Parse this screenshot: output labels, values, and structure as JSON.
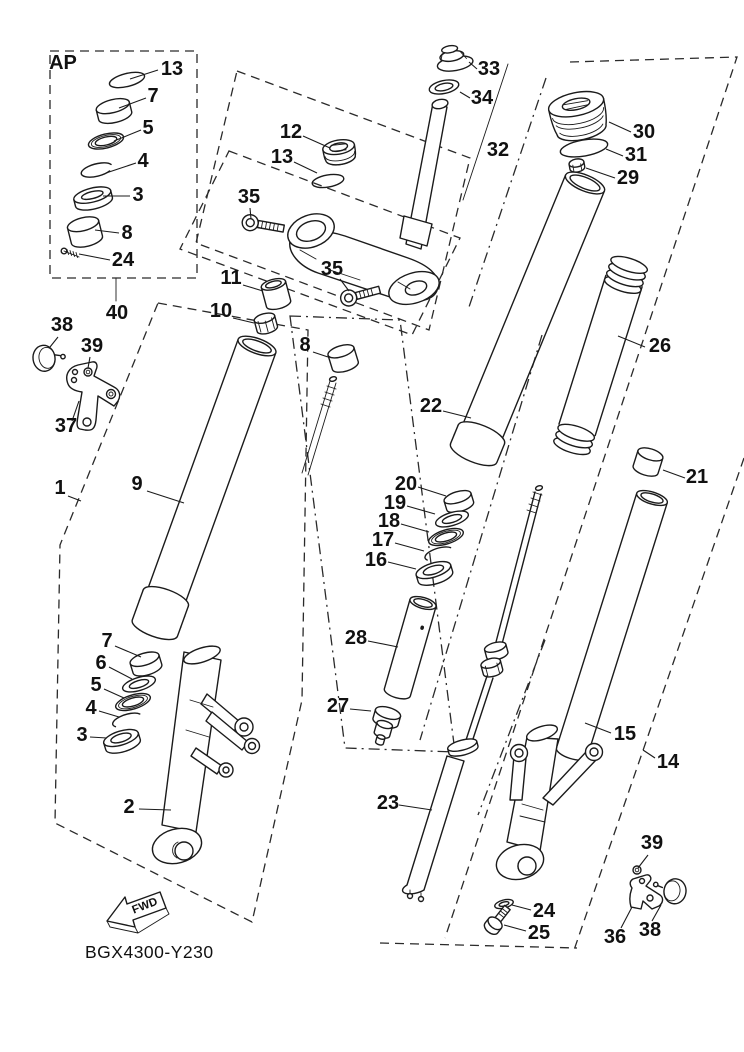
{
  "diagram": {
    "code": "BGX4300-Y230",
    "inset_label": "AP",
    "direction_arrow": "FWD",
    "line_color": "#1b1b1b",
    "background": "#ffffff"
  },
  "part_labels": [
    {
      "id": "ap13",
      "text": "13",
      "x": 172,
      "y": 75,
      "leader": [
        158,
        70,
        130,
        79
      ]
    },
    {
      "id": "ap7",
      "text": "7",
      "x": 153,
      "y": 102,
      "leader": [
        146,
        98,
        119,
        108
      ]
    },
    {
      "id": "ap5",
      "text": "5",
      "x": 148,
      "y": 134,
      "leader": [
        141,
        130,
        114,
        141
      ]
    },
    {
      "id": "ap4",
      "text": "4",
      "x": 143,
      "y": 167,
      "leader": [
        136,
        163,
        106,
        173
      ]
    },
    {
      "id": "ap3",
      "text": "3",
      "x": 138,
      "y": 201,
      "leader": [
        130,
        196,
        103,
        196
      ]
    },
    {
      "id": "ap8",
      "text": "8",
      "x": 127,
      "y": 239,
      "leader": [
        119,
        233,
        95,
        230
      ]
    },
    {
      "id": "ap24",
      "text": "24",
      "x": 123,
      "y": 266,
      "leader": [
        110,
        260,
        79,
        254
      ]
    },
    {
      "id": "n40",
      "text": "40",
      "x": 117,
      "y": 319
    },
    {
      "id": "n12",
      "text": "12",
      "x": 291,
      "y": 138,
      "leader": [
        303,
        136,
        330,
        148
      ]
    },
    {
      "id": "n13b",
      "text": "13",
      "x": 282,
      "y": 163,
      "leader": [
        294,
        162,
        317,
        173
      ]
    },
    {
      "id": "n35a",
      "text": "35",
      "x": 249,
      "y": 203,
      "leader": [
        250,
        208,
        251,
        219
      ]
    },
    {
      "id": "n35b",
      "text": "35",
      "x": 332,
      "y": 275,
      "leader": [
        340,
        279,
        349,
        291
      ]
    },
    {
      "id": "n33",
      "text": "33",
      "x": 489,
      "y": 75,
      "leader": [
        477,
        69,
        469,
        62
      ]
    },
    {
      "id": "n34",
      "text": "34",
      "x": 482,
      "y": 104,
      "leader": [
        470,
        98,
        460,
        92
      ]
    },
    {
      "id": "n32",
      "text": "32",
      "x": 498,
      "y": 156
    },
    {
      "id": "n30",
      "text": "30",
      "x": 644,
      "y": 138,
      "leader": [
        631,
        132,
        609,
        122
      ]
    },
    {
      "id": "n31",
      "text": "31",
      "x": 636,
      "y": 161,
      "leader": [
        623,
        156,
        606,
        149
      ]
    },
    {
      "id": "n29",
      "text": "29",
      "x": 628,
      "y": 184,
      "leader": [
        615,
        178,
        586,
        168
      ]
    },
    {
      "id": "n26",
      "text": "26",
      "x": 660,
      "y": 352,
      "leader": [
        645,
        347,
        618,
        336
      ]
    },
    {
      "id": "n38a",
      "text": "38",
      "x": 62,
      "y": 331,
      "leader": [
        58,
        337,
        50,
        347
      ]
    },
    {
      "id": "n39a",
      "text": "39",
      "x": 92,
      "y": 352,
      "leader": [
        90,
        357,
        88,
        368
      ]
    },
    {
      "id": "n37",
      "text": "37",
      "x": 66,
      "y": 432,
      "leader": [
        72,
        421,
        79,
        401
      ]
    },
    {
      "id": "n1",
      "text": "1",
      "x": 60,
      "y": 494,
      "leader": [
        68,
        496,
        81,
        501
      ]
    },
    {
      "id": "n9",
      "text": "9",
      "x": 137,
      "y": 490,
      "leader": [
        147,
        491,
        184,
        503
      ]
    },
    {
      "id": "n11",
      "text": "11",
      "x": 231,
      "y": 284,
      "leader": [
        243,
        285,
        263,
        291
      ]
    },
    {
      "id": "n10",
      "text": "10",
      "x": 221,
      "y": 317,
      "leader": [
        233,
        318,
        254,
        323
      ]
    },
    {
      "id": "n8b",
      "text": "8",
      "x": 305,
      "y": 351,
      "leader": [
        313,
        352,
        328,
        357
      ]
    },
    {
      "id": "n22",
      "text": "22",
      "x": 431,
      "y": 412,
      "leader": [
        443,
        411,
        471,
        418
      ]
    },
    {
      "id": "n20",
      "text": "20",
      "x": 406,
      "y": 490,
      "leader": [
        418,
        487,
        446,
        496
      ]
    },
    {
      "id": "n19",
      "text": "19",
      "x": 395,
      "y": 509,
      "leader": [
        407,
        506,
        435,
        514
      ]
    },
    {
      "id": "n18",
      "text": "18",
      "x": 389,
      "y": 527,
      "leader": [
        401,
        524,
        429,
        532
      ]
    },
    {
      "id": "n17",
      "text": "17",
      "x": 383,
      "y": 546,
      "leader": [
        395,
        543,
        424,
        551
      ]
    },
    {
      "id": "n16",
      "text": "16",
      "x": 376,
      "y": 566,
      "leader": [
        388,
        562,
        416,
        569
      ]
    },
    {
      "id": "n28",
      "text": "28",
      "x": 356,
      "y": 644,
      "leader": [
        368,
        641,
        398,
        647
      ]
    },
    {
      "id": "n27",
      "text": "27",
      "x": 338,
      "y": 712,
      "leader": [
        350,
        709,
        371,
        711
      ]
    },
    {
      "id": "n21",
      "text": "21",
      "x": 697,
      "y": 483,
      "leader": [
        685,
        478,
        663,
        470
      ]
    },
    {
      "id": "n15",
      "text": "15",
      "x": 625,
      "y": 740,
      "leader": [
        611,
        733,
        585,
        723
      ]
    },
    {
      "id": "n14",
      "text": "14",
      "x": 668,
      "y": 768,
      "leader": [
        655,
        758,
        643,
        750
      ]
    },
    {
      "id": "n7b",
      "text": "7",
      "x": 107,
      "y": 647,
      "leader": [
        115,
        646,
        141,
        657
      ]
    },
    {
      "id": "n6",
      "text": "6",
      "x": 101,
      "y": 669,
      "leader": [
        109,
        667,
        132,
        679
      ]
    },
    {
      "id": "n5b",
      "text": "5",
      "x": 96,
      "y": 691,
      "leader": [
        104,
        689,
        124,
        698
      ]
    },
    {
      "id": "n4b",
      "text": "4",
      "x": 91,
      "y": 714,
      "leader": [
        99,
        711,
        119,
        717
      ]
    },
    {
      "id": "n3b",
      "text": "3",
      "x": 82,
      "y": 741,
      "leader": [
        90,
        737,
        107,
        738
      ]
    },
    {
      "id": "n2",
      "text": "2",
      "x": 129,
      "y": 813,
      "leader": [
        139,
        809,
        171,
        810
      ]
    },
    {
      "id": "n23",
      "text": "23",
      "x": 388,
      "y": 809,
      "leader": [
        399,
        805,
        432,
        810
      ]
    },
    {
      "id": "n24b",
      "text": "24",
      "x": 544,
      "y": 917,
      "leader": [
        531,
        910,
        512,
        905
      ]
    },
    {
      "id": "n25",
      "text": "25",
      "x": 539,
      "y": 939,
      "leader": [
        526,
        931,
        504,
        925
      ]
    },
    {
      "id": "n39b",
      "text": "39",
      "x": 652,
      "y": 849,
      "leader": [
        648,
        855,
        638,
        868
      ]
    },
    {
      "id": "n36",
      "text": "36",
      "x": 615,
      "y": 943,
      "leader": [
        621,
        928,
        632,
        907
      ]
    },
    {
      "id": "n38b",
      "text": "38",
      "x": 650,
      "y": 936,
      "leader": [
        652,
        921,
        661,
        905
      ]
    }
  ]
}
